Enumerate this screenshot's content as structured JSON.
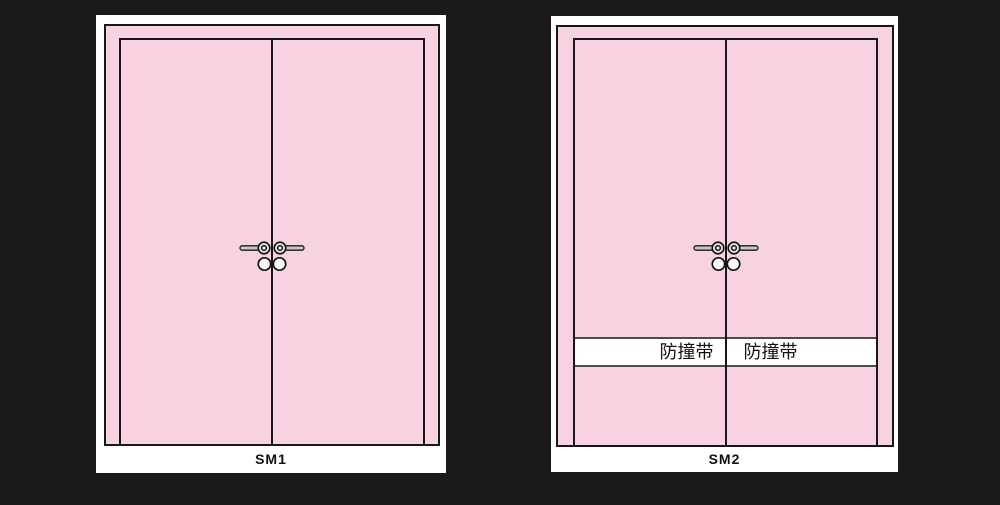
{
  "page": {
    "background": "#1b191a",
    "description": "Two pink double-door elevation drawings on dark background"
  },
  "colors": {
    "bg": "#1b191a",
    "panel-white": "#ffffff",
    "door-pink": "#f7d3e2",
    "line-black": "#1c161c",
    "band-line": "#4c4c4c",
    "handle-gray": "#c9c9c9",
    "text-black": "#111111"
  },
  "panels": [
    {
      "label": "SM1",
      "has_bumper_strip": false
    },
    {
      "label": "SM2",
      "has_bumper_strip": true,
      "bumper_strip": {
        "left_label": "防撞带",
        "right_label": "防撞带"
      }
    }
  ]
}
